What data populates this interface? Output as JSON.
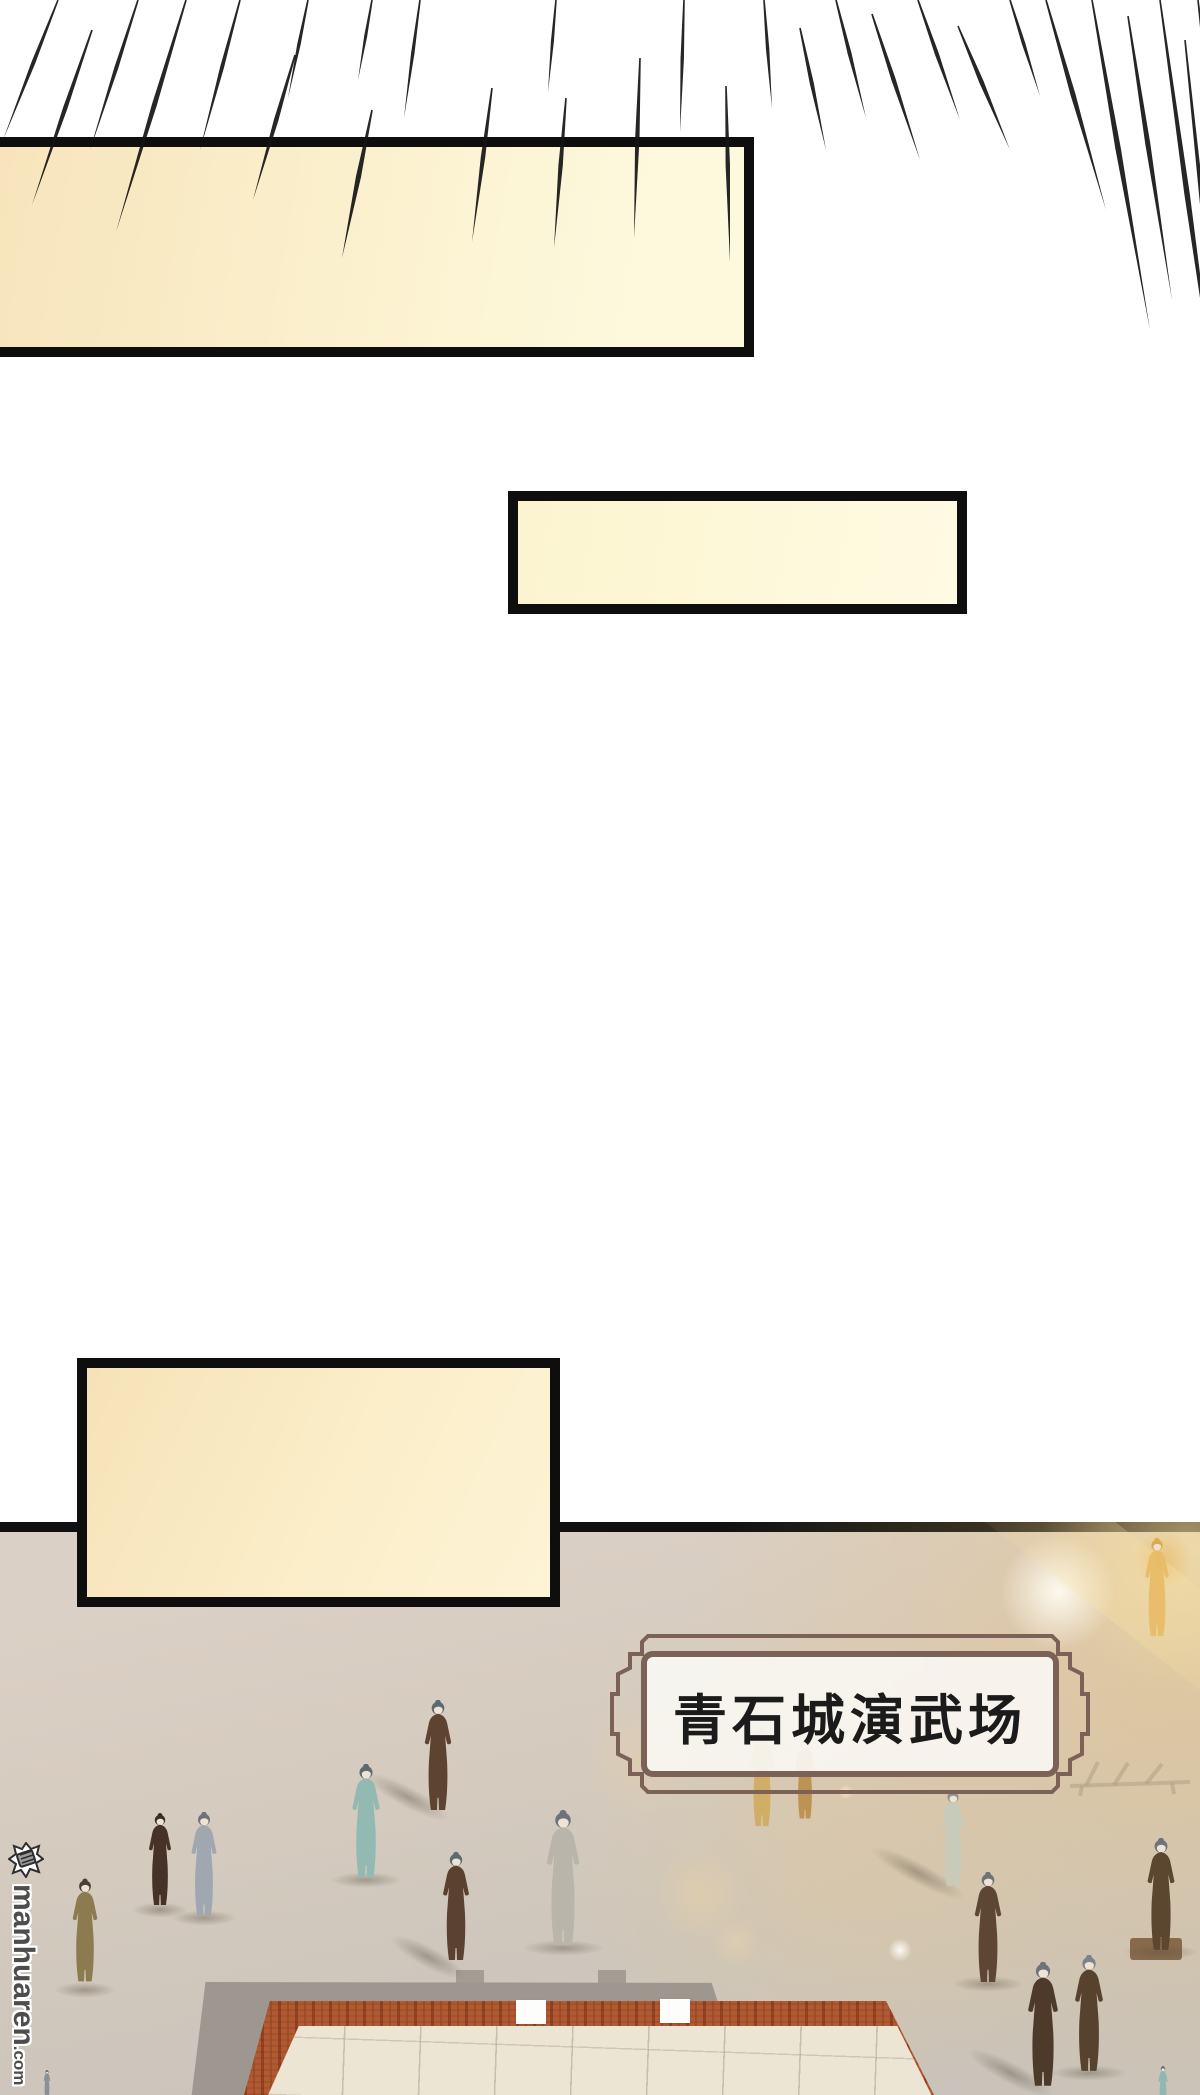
{
  "page": {
    "width": 1200,
    "height": 2095,
    "background": "#ffffff"
  },
  "speed_lines": {
    "color": "#141414",
    "rays": [
      [
        58,
        0,
        140,
        -55,
        4
      ],
      [
        92,
        30,
        205,
        -60,
        4.5
      ],
      [
        138,
        0,
        150,
        -48,
        4
      ],
      [
        186,
        0,
        232,
        -70,
        5
      ],
      [
        240,
        0,
        150,
        -40,
        4
      ],
      [
        295,
        55,
        200,
        -42,
        4.5
      ],
      [
        308,
        0,
        98,
        -20,
        3.5
      ],
      [
        372,
        0,
        80,
        -14,
        3
      ],
      [
        372,
        110,
        258,
        -30,
        5
      ],
      [
        420,
        0,
        118,
        -16,
        3.5
      ],
      [
        492,
        88,
        242,
        -20,
        4.5
      ],
      [
        556,
        0,
        92,
        -8,
        3
      ],
      [
        566,
        98,
        248,
        -12,
        4.5
      ],
      [
        640,
        58,
        238,
        -6,
        4.5
      ],
      [
        684,
        0,
        132,
        -4,
        3.5
      ],
      [
        726,
        86,
        262,
        4,
        4.5
      ],
      [
        764,
        0,
        108,
        8,
        3.5
      ],
      [
        800,
        28,
        150,
        26,
        4
      ],
      [
        836,
        0,
        118,
        30,
        4
      ],
      [
        872,
        14,
        160,
        48,
        4.5
      ],
      [
        918,
        0,
        120,
        42,
        4
      ],
      [
        958,
        26,
        150,
        52,
        4.5
      ],
      [
        1010,
        0,
        96,
        30,
        3.5
      ],
      [
        1046,
        0,
        210,
        60,
        5
      ],
      [
        1092,
        0,
        330,
        58,
        5.5
      ],
      [
        1128,
        16,
        300,
        44,
        5
      ],
      [
        1160,
        0,
        430,
        60,
        5.5
      ],
      [
        1185,
        40,
        470,
        45,
        5
      ],
      [
        1198,
        0,
        250,
        28,
        4
      ]
    ]
  },
  "speech_boxes": [
    {
      "x": -12,
      "y": 137,
      "w": 766,
      "h": 220,
      "fill": "linear-gradient(100deg,#f7e4bb 0%,#fbf0cd 45%,#fdf9dd 85%)"
    },
    {
      "x": 508,
      "y": 491,
      "w": 459,
      "h": 123,
      "fill": "linear-gradient(100deg,#fcf4cf 0%,#fdf8d8 50%,#fefbe3 100%)"
    },
    {
      "x": 77,
      "y": 1358,
      "w": 483,
      "h": 249,
      "fill": "linear-gradient(115deg,#f6e2b8 0%,#fbeec9 55%,#fdf4d6 100%)"
    }
  ],
  "divider": {
    "y": 1522,
    "height": 10,
    "color": "#101010"
  },
  "scene": {
    "top": 1522,
    "height": 573,
    "platform": {
      "apron": {
        "x": 190,
        "y": 1982,
        "w": 815,
        "h": 113
      },
      "tabs": [
        [
          456,
          1970,
          28,
          14
        ],
        [
          598,
          1970,
          28,
          14
        ]
      ],
      "red": {
        "x": 244,
        "y": 2001,
        "w": 738,
        "h": 94
      },
      "tiles": {
        "x": 268,
        "y": 2026,
        "w": 684,
        "h": 69
      },
      "white_blocks": [
        [
          516,
          2000,
          30,
          24
        ],
        [
          660,
          1999,
          30,
          24
        ]
      ]
    },
    "figures": [
      {
        "x": 66,
        "y": 1872,
        "w": 38,
        "h": 118,
        "robe": "#8c7b50",
        "hair": "#4a4038",
        "shadow": "plain"
      },
      {
        "x": 143,
        "y": 1810,
        "w": 34,
        "h": 100,
        "robe": "#463227",
        "hair": "#3a2d24",
        "shadow": "plain"
      },
      {
        "x": 184,
        "y": 1812,
        "w": 40,
        "h": 106,
        "robe": "#9fa8b0",
        "hair": "#6d737b",
        "shadow": "plain"
      },
      {
        "x": 344,
        "y": 1764,
        "w": 44,
        "h": 116,
        "robe": "#93bab2",
        "hair": "#5d6a70",
        "shadow": "plain"
      },
      {
        "x": 416,
        "y": 1700,
        "w": 44,
        "h": 112,
        "robe": "#5c4431",
        "hair": "#5d6a70",
        "shadow": "long"
      },
      {
        "x": 436,
        "y": 1842,
        "w": 40,
        "h": 130,
        "robe": "#5a4130",
        "hair": "#5d6a70",
        "shadow": "long"
      },
      {
        "x": 538,
        "y": 1810,
        "w": 50,
        "h": 138,
        "robe": "#b9b5aa",
        "hair": "#6d737b",
        "shadow": "plain"
      },
      {
        "x": 928,
        "y": 1790,
        "w": 50,
        "h": 98,
        "robe": "#c8cbb9",
        "hair": "#8d9297",
        "shadow": "long"
      },
      {
        "x": 966,
        "y": 1872,
        "w": 44,
        "h": 112,
        "robe": "#5e4634",
        "hair": "#6d737b",
        "shadow": "plain"
      },
      {
        "x": 1020,
        "y": 1962,
        "w": 46,
        "h": 126,
        "robe": "#4e3a2b",
        "hair": "#6d737b",
        "shadow": "long"
      },
      {
        "x": 1066,
        "y": 1955,
        "w": 46,
        "h": 118,
        "robe": "#57422f",
        "hair": "#7d838a",
        "shadow": "plain"
      },
      {
        "x": 1138,
        "y": 1838,
        "w": 46,
        "h": 114,
        "robe": "#5b462f",
        "hair": "#6d737b",
        "shadow": "plain"
      },
      {
        "x": 1146,
        "y": 2066,
        "w": 34,
        "h": 40,
        "robe": "#8fb8b2",
        "hair": "#5d6a70",
        "shadow": "none"
      },
      {
        "x": 36,
        "y": 2070,
        "w": 22,
        "h": 28,
        "robe": "#8a9097",
        "hair": "#55595e",
        "shadow": "none"
      },
      {
        "x": 742,
        "y": 1728,
        "w": 40,
        "h": 100,
        "robe": "#d2a958",
        "hair": "#c49a4c",
        "shadow": "none",
        "opacity": 0.85
      },
      {
        "x": 786,
        "y": 1738,
        "w": 38,
        "h": 82,
        "robe": "#b98a45",
        "hair": "#a87c3e",
        "shadow": "none",
        "opacity": 0.85
      },
      {
        "x": 1136,
        "y": 1538,
        "w": 42,
        "h": 100,
        "robe": "#e8bc66",
        "hair": "#d8a84f",
        "shadow": "none",
        "opacity": 0.9
      }
    ],
    "glows": [
      {
        "x": 1165,
        "y": 1680,
        "r": 480,
        "color": "rgba(240,195,110,0.36)"
      },
      {
        "x": 1190,
        "y": 1548,
        "r": 150,
        "color": "rgba(250,228,165,0.55)"
      },
      {
        "x": 820,
        "y": 1880,
        "r": 260,
        "color": "rgba(238,200,130,0.22)"
      },
      {
        "x": 1058,
        "y": 1592,
        "r": 58,
        "color": "rgba(255,252,242,0.95)"
      },
      {
        "x": 1163,
        "y": 1560,
        "r": 30,
        "color": "rgba(233,180,80,0.55)"
      },
      {
        "x": 900,
        "y": 1950,
        "r": 12,
        "color": "rgba(255,253,248,0.95)"
      },
      {
        "x": 846,
        "y": 1792,
        "r": 8,
        "color": "rgba(255,232,190,0.8)"
      },
      {
        "x": 700,
        "y": 1895,
        "r": 45,
        "color": "rgba(242,214,160,0.35)"
      },
      {
        "x": 736,
        "y": 1942,
        "r": 25,
        "color": "rgba(244,216,165,0.32)"
      },
      {
        "x": 640,
        "y": 1760,
        "r": 60,
        "color": "rgba(240,210,150,0.25)"
      }
    ],
    "stand": {
      "x": 1130,
      "y": 1938,
      "w": 52,
      "h": 22,
      "color": "#7a5b3a"
    },
    "rack": {
      "x": 1068,
      "y": 1760,
      "w": 124,
      "h": 38
    }
  },
  "plaque": {
    "x": 608,
    "y": 1628,
    "w": 484,
    "h": 172,
    "title": "青石城演武场",
    "frame_color": "#7b6156",
    "fill": "rgba(249,246,241,0.93)",
    "text_color": "#1b1b1b",
    "title_size": 54
  },
  "watermark": {
    "site": "manhuaren",
    "tld": ".com",
    "color": "#4d4d4d",
    "logo": {
      "x": 8,
      "y": 1842,
      "size": 36
    },
    "text_x": 12,
    "text_y": 1884
  }
}
